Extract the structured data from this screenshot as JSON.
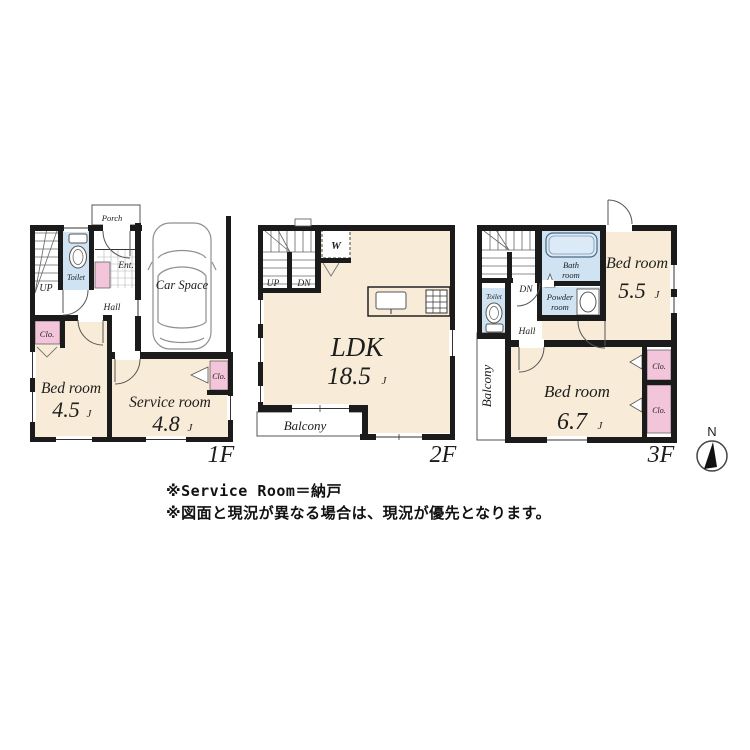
{
  "floors": {
    "f1": {
      "label": "1F",
      "stairs": "UP",
      "toilet": "Toilet",
      "porch": "Porch",
      "entrance": "Ent.",
      "hall": "Hall",
      "car_space": "Car Space",
      "closet_a": "Clo.",
      "closet_b": "Clo.",
      "bedroom": {
        "name": "Bed room",
        "area": "4.5",
        "unit": "J"
      },
      "service_room": {
        "name": "Service room",
        "area": "4.8",
        "unit": "J"
      }
    },
    "f2": {
      "label": "2F",
      "stairs_up": "UP",
      "stairs_dn": "DN",
      "closet_w": "W",
      "ldk": {
        "name": "LDK",
        "area": "18.5",
        "unit": "J"
      },
      "balcony": "Balcony"
    },
    "f3": {
      "label": "3F",
      "stairs_dn": "DN",
      "toilet": "Toilet",
      "bath": {
        "line1": "Bath",
        "line2": "room"
      },
      "powder": {
        "line1": "Powder",
        "line2": "room"
      },
      "hall": "Hall",
      "balcony": "Balcony",
      "bedroom_a": {
        "name": "Bed room",
        "area": "5.5",
        "unit": "J"
      },
      "bedroom_b": {
        "name": "Bed room",
        "area": "6.7",
        "unit": "J"
      },
      "closet_a": "Clo.",
      "closet_b": "Clo."
    }
  },
  "compass": {
    "north": "N"
  },
  "notes": {
    "line1": "※Service Room＝納戸",
    "line2": "※図面と現況が異なる場合は、現況が優先となります。"
  },
  "colors": {
    "wall": "#1b1b1b",
    "room_cream": "#f8ecd8",
    "closet_pink": "#f3c5da",
    "wet_blue": "#cfe3f2",
    "tub_fill": "#dce9f6"
  }
}
